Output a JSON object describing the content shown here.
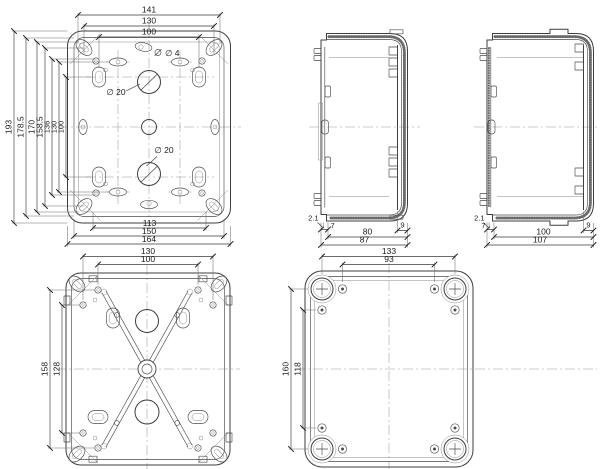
{
  "drawing_title": "enclosure-technical-drawing",
  "palette": {
    "background": "#ffffff",
    "object_line": "#3d3d3d",
    "thin_line": "#8a8a8a",
    "centerline": "#9a9a9a",
    "dimension_text": "#1b1b1b"
  },
  "views": {
    "front": {
      "dim_top": [
        "141",
        "130",
        "100"
      ],
      "dim_left": [
        "193",
        "178.5",
        "170",
        "158.5",
        "136",
        "130",
        "100"
      ],
      "dim_bottom": [
        "113",
        "150",
        "164"
      ],
      "labels": {
        "hole_top": "∅ 4",
        "knockout_upper": "∅ 20",
        "knockout_lower": "∅ 20"
      }
    },
    "side_small": {
      "wall": "2.1",
      "lip": "7",
      "depth": "80",
      "overall": "87",
      "edge": "9"
    },
    "side_large": {
      "wall": "2.1",
      "lip": "7",
      "depth": "100",
      "overall": "107",
      "edge": "9"
    },
    "back": {
      "dim_top": [
        "130",
        "100"
      ],
      "dim_left": [
        "158",
        "128"
      ]
    },
    "cover": {
      "dim_top": [
        "133",
        "93"
      ],
      "dim_left": [
        "160",
        "118"
      ]
    }
  }
}
